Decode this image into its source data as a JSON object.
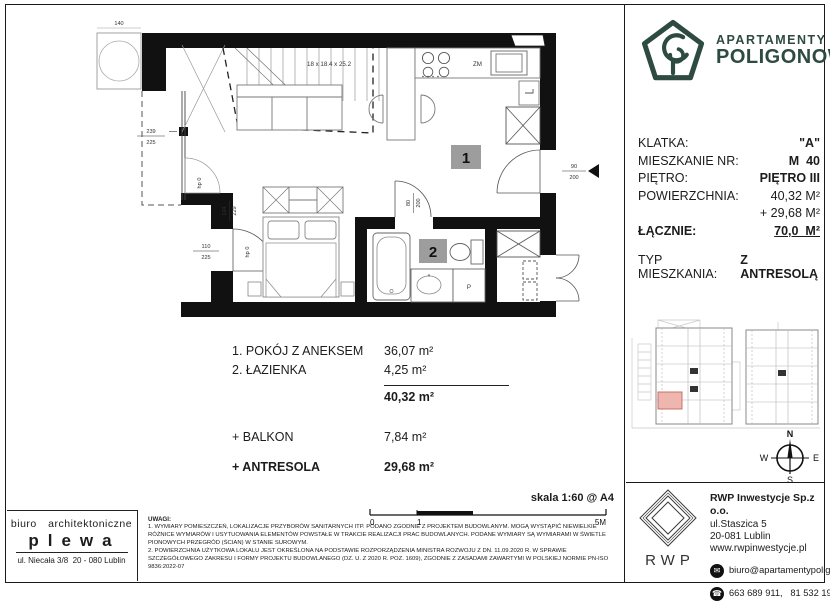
{
  "brand": {
    "line1": "APARTAMENTY",
    "line2": "POLIGONOWA",
    "color": "#2e4b42"
  },
  "details": {
    "rows": [
      {
        "label": "KLATKA:",
        "value": "\"A\""
      },
      {
        "label": "MIESZKANIE NR:",
        "value": "M  40"
      },
      {
        "label": "PIĘTRO:",
        "value": "PIĘTRO III"
      },
      {
        "label": "POWIERZCHNIA:",
        "value": "40,32 M²"
      },
      {
        "label": "",
        "value": "+ 29,68 M²"
      },
      {
        "label": "ŁĄCZNIE:",
        "value": "70,0  M²"
      }
    ],
    "type_label": "TYP MIESZKANIA:",
    "type_value": "Z ANTRESOLĄ"
  },
  "rooms": {
    "items": [
      {
        "name": "1. POKÓJ Z ANEKSEM",
        "area": "36,07 m²"
      },
      {
        "name": "2. ŁAZIENKA",
        "area": "4,25 m²"
      }
    ],
    "total": "40,32 m²",
    "extras": [
      {
        "name": "+ BALKON",
        "area": "7,84 m²"
      },
      {
        "name": "+ ANTRESOLA",
        "area": "29,68 m²"
      }
    ]
  },
  "plan": {
    "stairs_note": "18 x 18.4 x 25.2",
    "dishwasher": "ZM",
    "washer": "P",
    "room1_badge": "1",
    "room2_badge": "2",
    "entrance_dim_top": "90",
    "entrance_dim_bottom": "200",
    "balcony_door_dim_top": "110",
    "balcony_door_dim_bottom": "225",
    "bath_door_dim_top": "80",
    "bath_door_dim_bottom": "200",
    "window_dim_top": "239",
    "window_dim_bottom": "225",
    "side_dim_a": "124",
    "side_dim_b": "229",
    "parapet_note": "hp 0",
    "column_dim": "140"
  },
  "scale": {
    "label": "skala 1:60 @ A4",
    "tick0": "0",
    "tick1": "1",
    "tick5": "5M"
  },
  "architect": {
    "line1": "biuro architektoniczne",
    "line2": "plewa",
    "line3": "ul. Niecała 3/8  20 - 080 Lublin"
  },
  "notes": {
    "title": "UWAGI:",
    "note1": "1. WYMIARY POMIESZCZEŃ, LOKALIZACJE PRZYBORÓW SANITARNYCH ITP. PODANO ZGODNIE Z PROJEKTEM BUDOWLANYM. MOGĄ WYSTĄPIĆ NIEWIELKIE RÓŻNICE WYMIARÓW I USYTUOWANIA ELEMENTÓW POWSTAŁE W TRAKCIE REALIZACJI PRAC BUDOWLANYCH. PODANE WYMIARY SĄ WYMIARAMI W ŚWIETLE PIONOWYCH PRZEGRÓD (ŚCIAN) W STANIE SUROWYM.",
    "note2": "2. POWIERZCHNIA UŻYTKOWA LOKALU JEST OKREŚLONA NA PODSTAWIE ROZPORZĄDZENIA MINISTRA ROZWOJU Z DN. 11.09.2020 R. W SPRAWIE SZCZEGÓŁOWEGO ZAKRESU I FORMY PROJEKTU BUDOWLANEGO (DZ. U. Z 2020 R. POZ. 1609), ZGODNIE Z ZASADAMI ZAWARTYMI W POLSKIEJ NORMIE PN-ISO 9836:2022-07"
  },
  "compass": {
    "n": "N",
    "e": "E",
    "s": "S",
    "w": "W"
  },
  "developer": {
    "logo_text": "RWP",
    "company": "RWP Inwestycje Sp.z o.o.",
    "street": "ul.Staszica 5",
    "city": "20-081 Lublin",
    "web": "www.rwpinwestycje.pl",
    "email": "biuro@apartamentypoligonowa.pl",
    "phones": "663 689 911,   81 532 19 66"
  }
}
